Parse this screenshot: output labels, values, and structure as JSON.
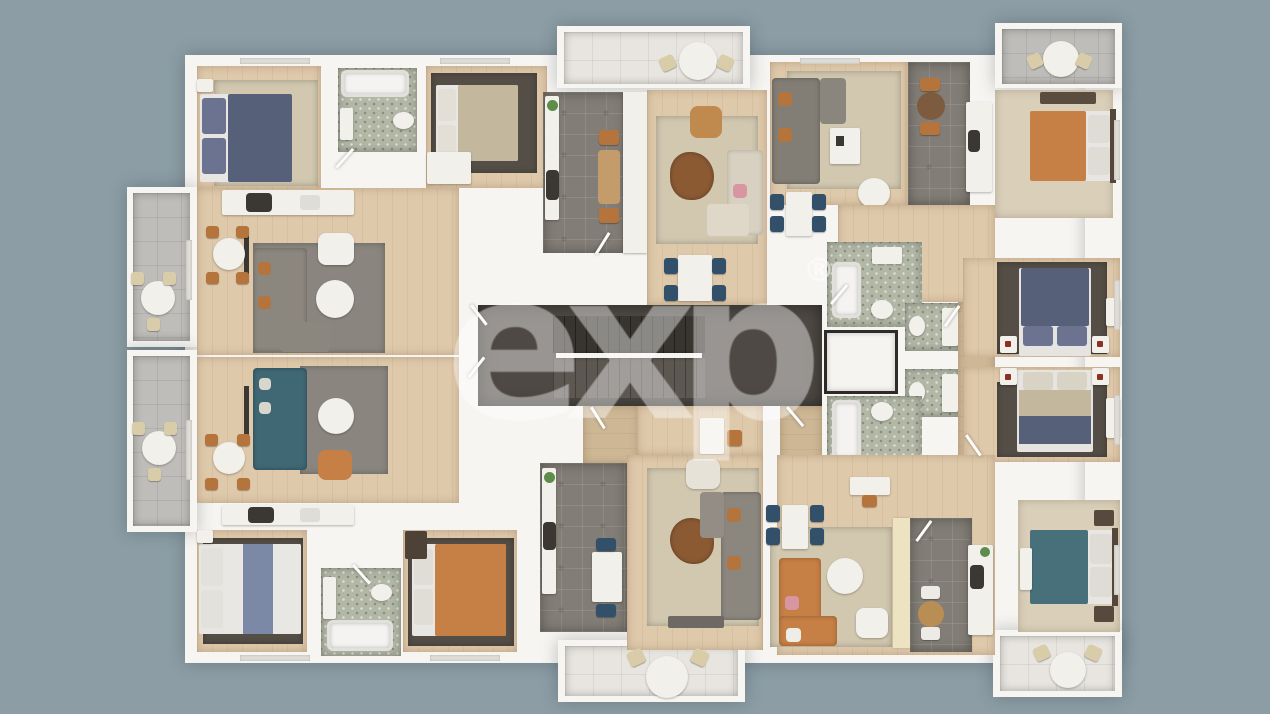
{
  "watermark": {
    "text": "exp",
    "registered_mark": "®"
  },
  "scene": {
    "description": "3D rendered top-down floor plan of one level of a residential apartment building with six apartments around a central stair and elevator core, balconies on all sides",
    "width_px": 1270,
    "height_px": 714
  },
  "colors": {
    "bg": "#8C9DA5",
    "wall": "#F7F5F2",
    "wood": "#DFC9AB",
    "woodD": "#CDB795",
    "carpet": "#DAD0BA",
    "tileK": "#827D76",
    "tileB": "#B2B7A6",
    "cor": "#4E4944",
    "stairU": "#38342F",
    "stairL": "#5C5751",
    "balcT": "#E8E5E0",
    "balcG": "#BFBDB9",
    "rugBe": "#D2C8B0",
    "rugGr": "#8A867F",
    "rugDk": "#544E46",
    "navy": "#566078",
    "navyP": "#6B7390",
    "teal": "#47707B",
    "tealSofa": "#3F6874",
    "orange": "#C67F45",
    "beigeBed": "#C3B89E",
    "blueStripe": "#7C89A6",
    "fw": "#F2F0EB",
    "chN": "#33506B",
    "chO": "#B5743C",
    "chB": "#D9CDA9",
    "graySofa": "#8B867E",
    "tanChair": "#C08A4E",
    "brown": "#8B5A33",
    "tblBrown": "#C49B6A",
    "green": "#5E8C4A",
    "pink": "#D796A2",
    "red": "#8E2F23",
    "dkFurn": "#3B3733",
    "dkWood": "#55483A",
    "cream": "#EDE3C2",
    "wm": "rgba(255,255,255,0.42)",
    "wmr": "rgba(255,255,255,0.5)"
  }
}
